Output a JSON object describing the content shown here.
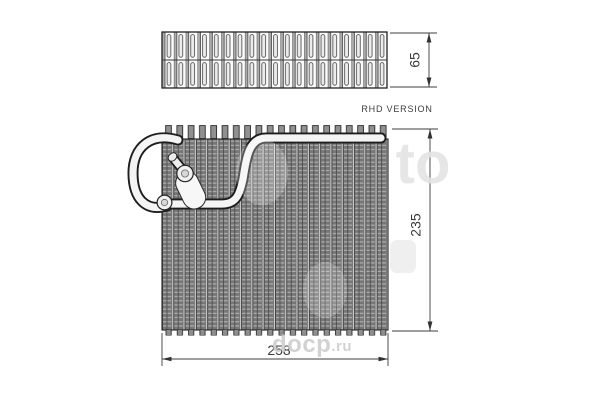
{
  "drawing": {
    "label_rhd": "RHD VERSION",
    "dim_top_height": "65",
    "dim_core_height": "235",
    "dim_core_width": "258"
  },
  "watermark": {
    "big_fragment": "to",
    "site_text": "docp",
    "site_suffix": ".ru"
  },
  "colors": {
    "background": "#ffffff",
    "line": "#222222",
    "fin_dark": "#6f6f6f",
    "fin_light": "#cfcfcf",
    "pipe_fill": "#f4f4f4",
    "watermark_gray": "#cbcbcb"
  }
}
